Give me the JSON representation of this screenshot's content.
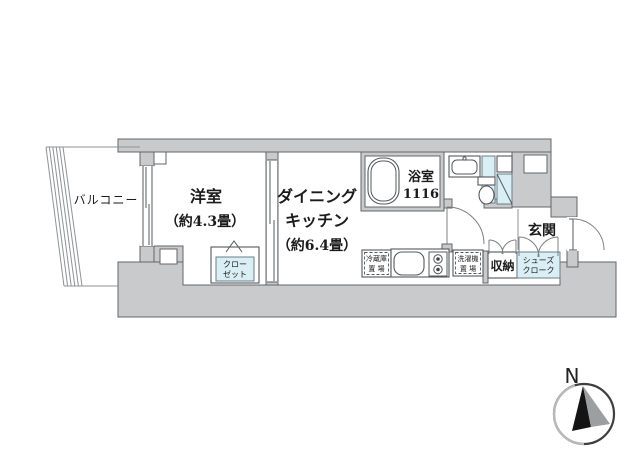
{
  "floorplan": {
    "balcony": {
      "label": "バルコニー"
    },
    "western_room": {
      "label": "洋室",
      "size_label": "（約4.3畳）"
    },
    "dining_kitchen": {
      "label_line1": "ダイニング",
      "label_line2": "キッチン",
      "size_label": "（約6.4畳）"
    },
    "bathroom": {
      "label": "浴室",
      "size_label": "1116"
    },
    "entrance": {
      "label": "玄関"
    },
    "storage": {
      "label": "収納"
    },
    "shoe_closet": {
      "label_line1": "シューズ",
      "label_line2": "クローク"
    },
    "closet": {
      "label_line1": "クロー",
      "label_line2": "ゼット"
    },
    "refrigerator_space": {
      "label_line1": "冷蔵庫",
      "label_line2": "置 場"
    },
    "washer_space": {
      "label_line1": "洗濯機",
      "label_line2": "置 場"
    },
    "compass": {
      "label": "N"
    },
    "colors": {
      "wall_fill": "#c9cacb",
      "wall_stroke": "#626568",
      "fixture_blue": "#daeef5",
      "line_gray": "#7d8084",
      "text": "#1b1b1b"
    }
  }
}
